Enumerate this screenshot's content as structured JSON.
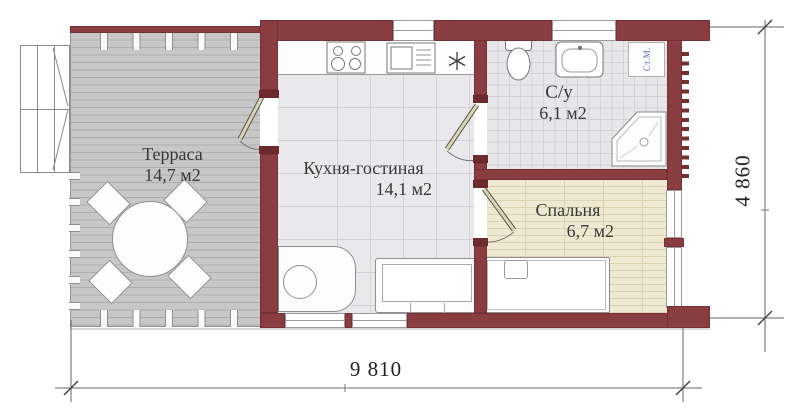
{
  "plan": {
    "title": "studio house floor plan",
    "rooms": [
      {
        "name": "Терраса",
        "area": "14,7 м2"
      },
      {
        "name": "Кухня-гостиная",
        "area": "14,1 м2"
      },
      {
        "name": "С/у",
        "area": "6,1 м2"
      },
      {
        "name": "Спальня",
        "area": "6,7 м2"
      }
    ],
    "labels": {
      "washing_machine": "Ст.М."
    },
    "dimensions": {
      "overall_width_mm": "9 810",
      "overall_height_mm": "4 860"
    },
    "colors": {
      "wall": "#8a3d40",
      "terrace_floor": "#c7c7c7",
      "kitchen_floor": "#e9e9ec",
      "bathroom_floor": "#e7e7ea",
      "bedroom_floor": "#f0e9d2",
      "washing_machine_text": "#6468bf"
    }
  }
}
